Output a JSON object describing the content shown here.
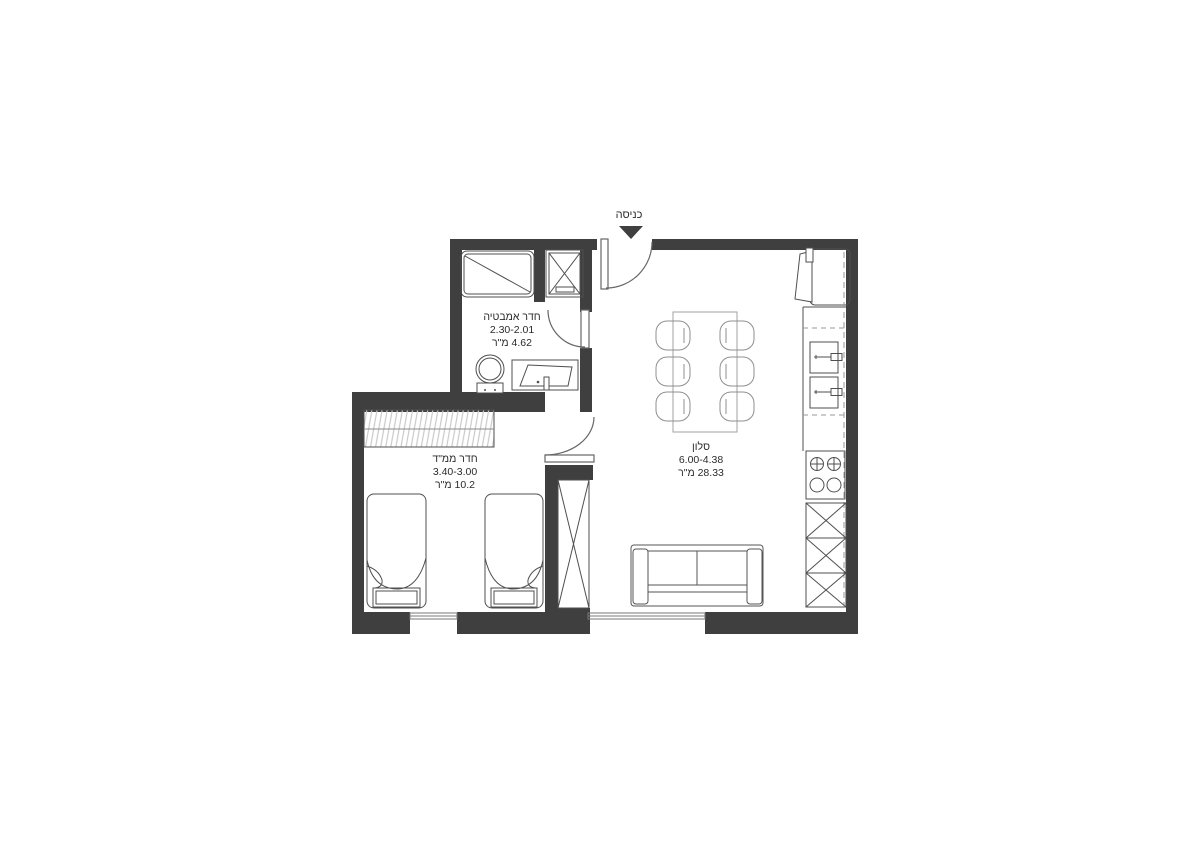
{
  "entrance": {
    "label": "כניסה"
  },
  "rooms": [
    {
      "id": "bathroom",
      "name": "חדר אמבטיה",
      "dimensions": "2.30-2.01",
      "area": "4.62 מ\"ר"
    },
    {
      "id": "safe-room",
      "name": "חדר ממ\"ד",
      "dimensions": "3.40-3.00",
      "area": "10.2 מ\"ר"
    },
    {
      "id": "living-room",
      "name": "סלון",
      "dimensions": "6.00-4.38",
      "area": "28.33 מ\"ר"
    }
  ],
  "colors": {
    "wall": "#3f3f3f",
    "fixture_line": "#4f4f4f",
    "light_line": "#8f8f8f",
    "hatch": "#c9c9c9",
    "text": "#2b2b2b"
  }
}
